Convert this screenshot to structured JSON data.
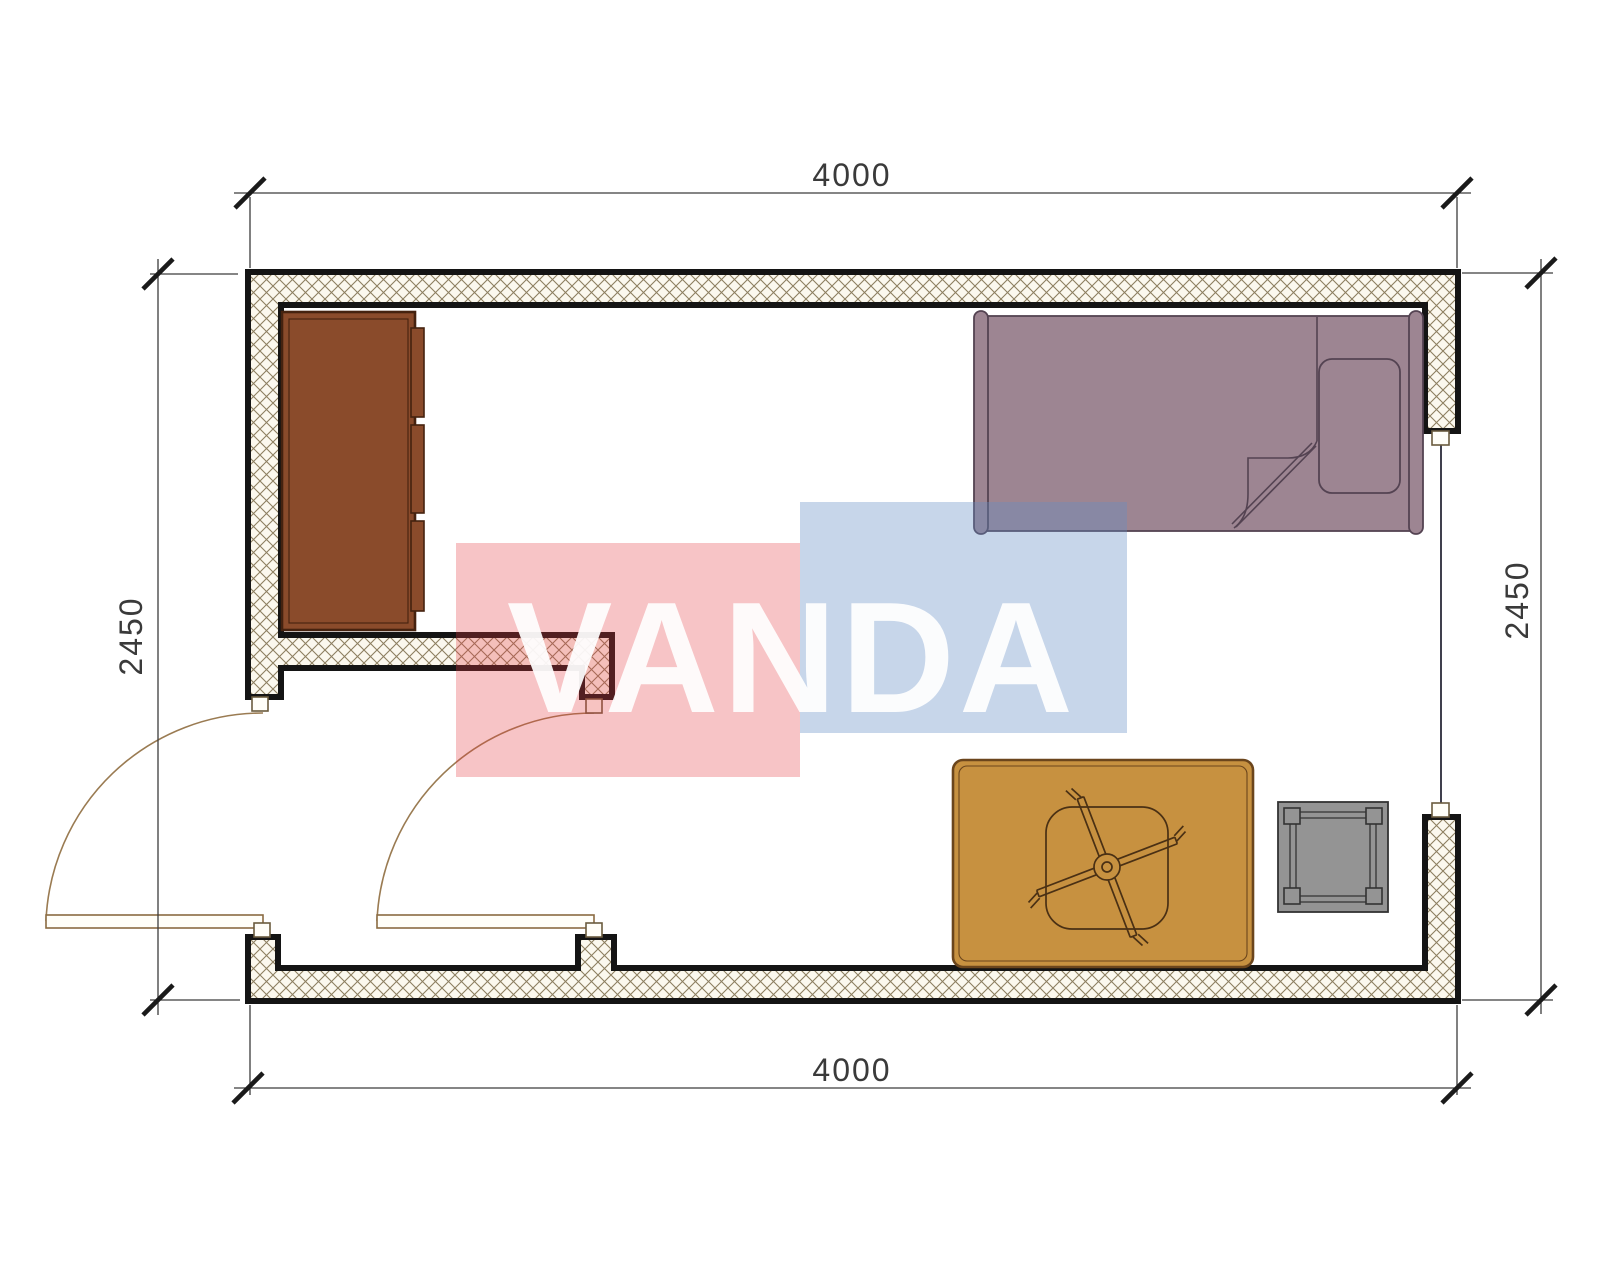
{
  "drawing": {
    "kind": "single-room floor plan",
    "dimensions": {
      "top": "4000",
      "bottom": "4000",
      "left": "2450",
      "right": "2450"
    },
    "watermark": {
      "text": "VANDA"
    },
    "furniture": [
      "wardrobe",
      "bed",
      "pillow",
      "blanket",
      "table",
      "office-chair",
      "stool"
    ],
    "openings": [
      "entry-door",
      "interior-door",
      "window"
    ]
  },
  "colors": {
    "wall_stroke": "#141414",
    "hatch_line": "#8d7f60",
    "hatch_bg": "#fbf8ee",
    "dim_line": "#3c3c3c",
    "dim_text": "#3a3a3a",
    "jamb_fill": "#fffef8",
    "window_line": "#2a2a3a",
    "door_arc": "#9a7b52",
    "door_leaf_stroke": "#8a6b42",
    "wardrobe_fill": "#8a4b2b",
    "wardrobe_stroke": "#45220f",
    "bed_fill": "#9d8592",
    "bed_stroke": "#544352",
    "table_fill": "#c79140",
    "table_stroke": "#6b451c",
    "chair_stroke": "#4a3014",
    "stool_fill": "#949494",
    "stool_stroke": "#333333",
    "wm_red": "rgba(228,60,65,0.30)",
    "wm_blue": "rgba(100,140,198,0.36)",
    "wm_text": "#ffffff"
  }
}
